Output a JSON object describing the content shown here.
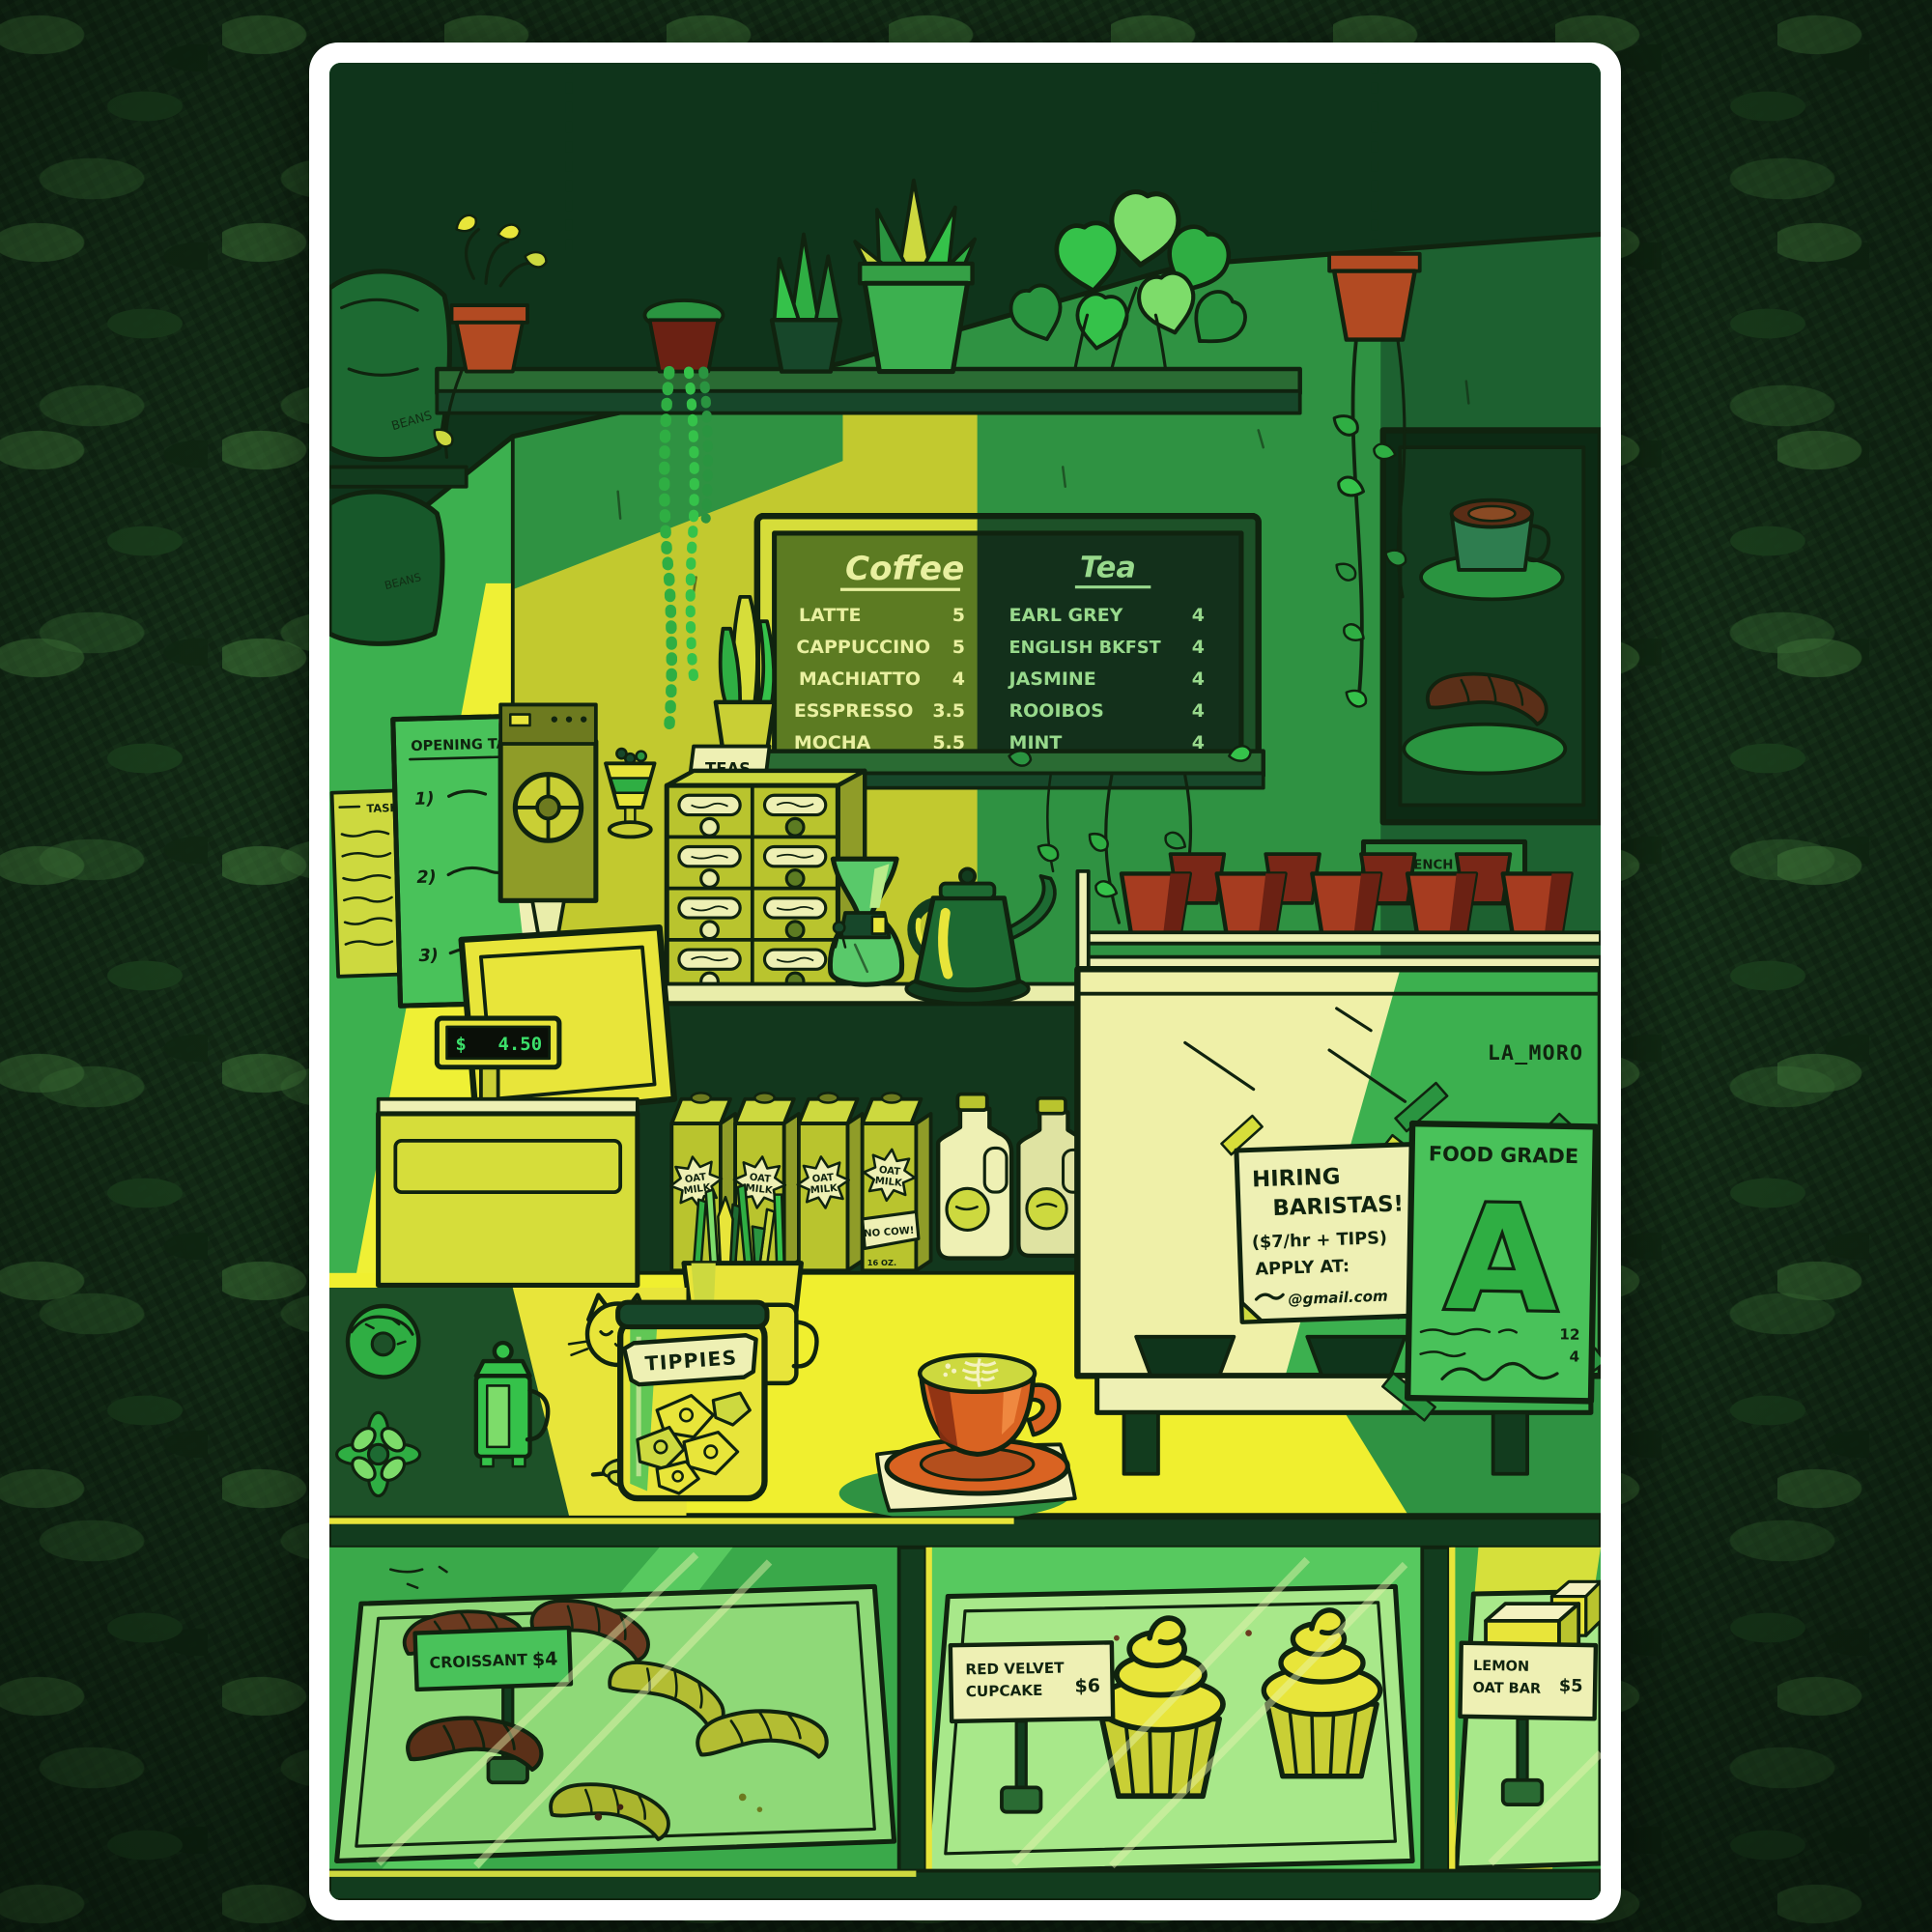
{
  "poster": {
    "shelf_bags_label": "BEANS",
    "menu_board": {
      "coffee": {
        "heading": "Coffee",
        "items": [
          {
            "name": "LATTE",
            "price": "5"
          },
          {
            "name": "CAPPUCCINO",
            "price": "5"
          },
          {
            "name": "MACHIATTO",
            "price": "4"
          },
          {
            "name": "ESSPRESSO",
            "price": "3.5"
          },
          {
            "name": "MOCHA",
            "price": "5.5"
          }
        ]
      },
      "tea": {
        "heading": "Tea",
        "items": [
          {
            "name": "EARL GREY",
            "price": "4"
          },
          {
            "name": "ENGLISH BKFST",
            "price": "4"
          },
          {
            "name": "JASMINE",
            "price": "4"
          },
          {
            "name": "ROOIBOS",
            "price": "4"
          },
          {
            "name": "MINT",
            "price": "4"
          }
        ]
      }
    },
    "wall_notes": {
      "side_title": "TASKS",
      "opening_title": "OPENING TASKS",
      "markers": [
        "1)",
        "2)",
        "3)"
      ]
    },
    "teas_cabinet_label": "TEAS",
    "framed_art_placard": {
      "title": "\"FRENCH FARE\"",
      "handle": "@TANNIN.ARCEO"
    },
    "register_display": {
      "currency": "$",
      "amount": "4.50"
    },
    "oat_milk": {
      "name_line1": "OAT",
      "name_line2": "MILK",
      "banner": "NO COW!",
      "size": "16 OZ."
    },
    "tip_jar_label": "TIPPIES",
    "espresso_brand": "LA_MORO",
    "hiring_note": {
      "line1": "HIRING",
      "line2": "BARISTAS!",
      "line3": "($7/hr + TIPS)",
      "line4": "APPLY AT:",
      "line5_suffix": "@gmail.com"
    },
    "food_grade_poster": {
      "title": "FOOD GRADE",
      "grade": "A",
      "number1": "12",
      "number2": "4"
    },
    "price_tags": {
      "croissant": {
        "name": "CROISSANT",
        "price": "$4"
      },
      "cupcake": {
        "line1": "RED VELVET",
        "line2": "CUPCAKE",
        "price": "$6"
      },
      "oat_bar": {
        "line1": "LEMON",
        "line2": "OAT BAR",
        "price": "$5"
      }
    },
    "colors": {
      "sun_yellow": "#f0ef2f",
      "lit_wall": "#c2c92f",
      "bright_green": "#3cb04f",
      "mid_green": "#2f9242",
      "dark_green": "#1d5128",
      "deep_green": "#0f341b",
      "terracotta": "#b24a22",
      "cup_orange": "#d96322",
      "cup_red": "#a63c20",
      "croissant_brown": "#6b3a20",
      "chalk_light": "#e9f0a0",
      "chalk_green": "#98d98c",
      "lcd_green": "#3ce06a"
    }
  }
}
